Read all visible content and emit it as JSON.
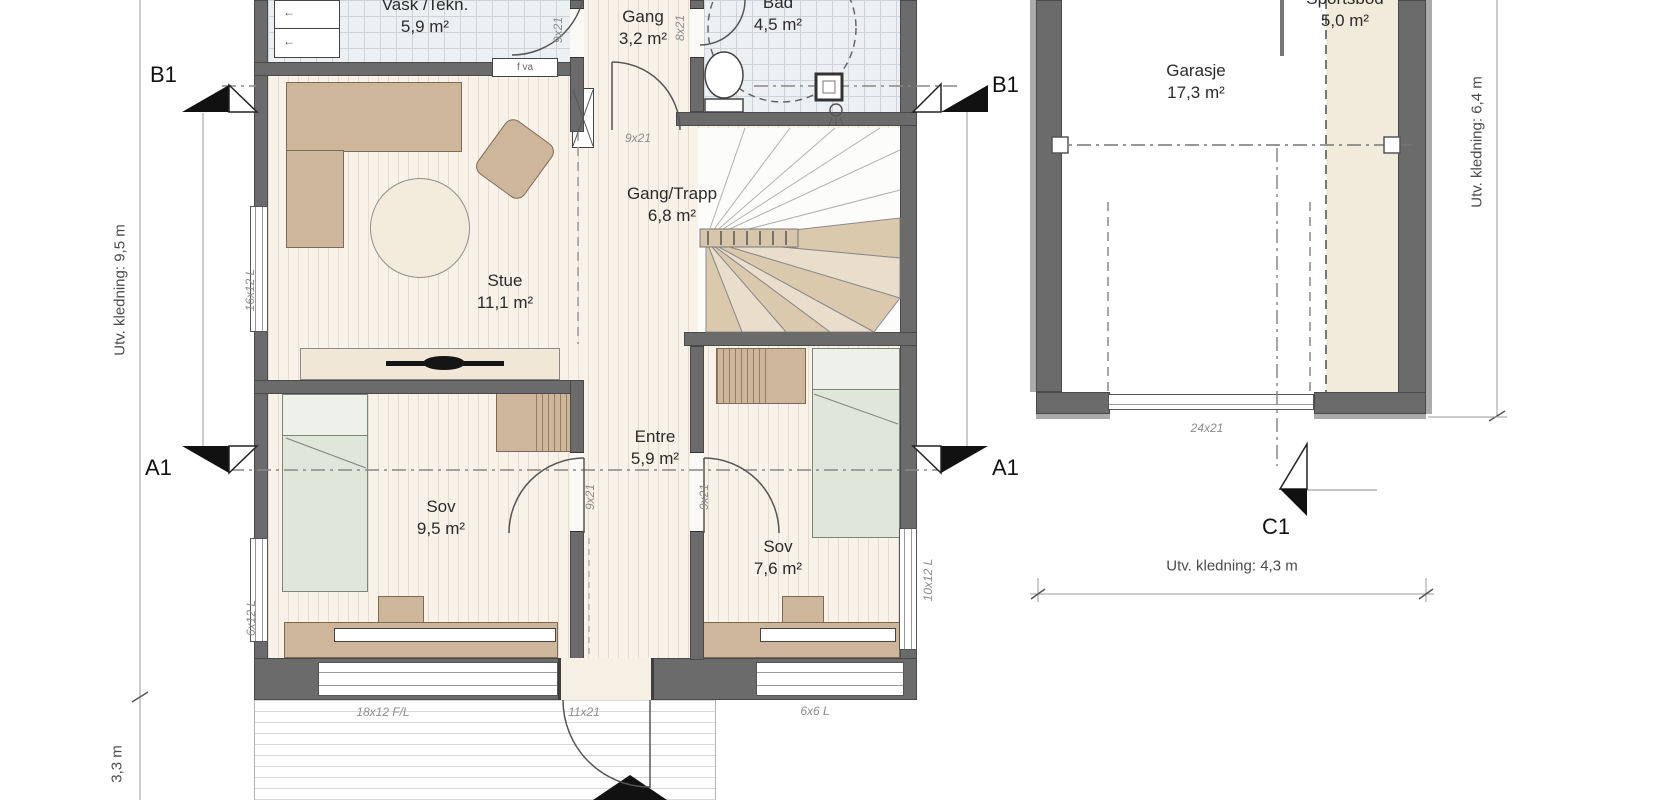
{
  "colors": {
    "wall": "#6b6b6b",
    "furniture_tan": "#cdb69a",
    "bed_green": "#dfe7da",
    "floor_wood": "#f8f2e9",
    "floor_tile": "#edf0f3",
    "sportsbod_floor": "#f2ebdc",
    "stair_tread": "#dbc9ae"
  },
  "rooms": {
    "vask": {
      "name": "Vask /Tekn.",
      "area": "5,9 m²"
    },
    "gang": {
      "name": "Gang",
      "area": "3,2 m²"
    },
    "bad": {
      "name": "Bad",
      "area": "4,5 m²"
    },
    "stue": {
      "name": "Stue",
      "area": "11,1 m²"
    },
    "gang_trapp": {
      "name": "Gang/Trapp",
      "area": "6,8 m²"
    },
    "entre": {
      "name": "Entre",
      "area": "5,9 m²"
    },
    "sov1": {
      "name": "Sov",
      "area": "9,5 m²"
    },
    "sov2": {
      "name": "Sov",
      "area": "7,6 m²"
    },
    "garasje": {
      "name": "Garasje",
      "area": "17,3 m²"
    },
    "sportsbod": {
      "name": "Sportsbod",
      "area": "5,0 m²"
    }
  },
  "markers": {
    "b1_left": "B1",
    "b1_right": "B1",
    "a1_left": "A1",
    "a1_right": "A1",
    "c1": "C1"
  },
  "dimensions": {
    "left_main": "Utv. kledning: 9,5 m",
    "left_deck": "3,3 m",
    "garage_right": "Utv. kledning: 6,4 m",
    "garage_bottom": "Utv. kledning: 4,3 m"
  },
  "openings": {
    "window_stue_left": "16x12 L",
    "window_sov1_left": "6x12 L",
    "window_sov2_right": "10x12 L",
    "window_south_large": "18x12 F/L",
    "entrance_door": "11x21",
    "window_south_small": "6x6 L",
    "door_gang_trapp": "9x21",
    "door_vask": "9x21",
    "door_bad": "8x21",
    "door_sov1": "9x21",
    "door_sov2": "9x21",
    "garage_door": "24x21",
    "wall_vent": "f va"
  },
  "icons": {
    "appliance_arrow": "←"
  }
}
